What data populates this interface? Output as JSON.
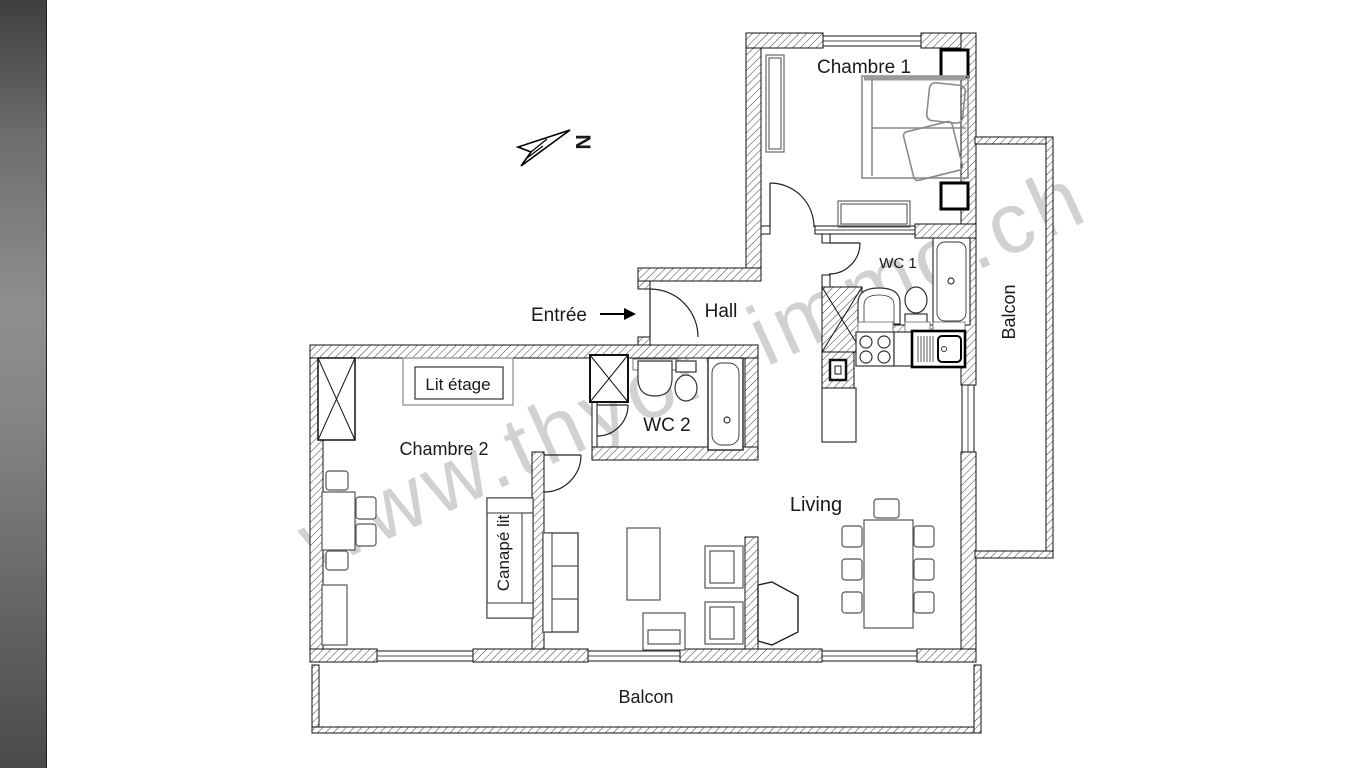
{
  "document": {
    "kind": "apartment-floor-plan"
  },
  "labels": {
    "chambre1": "Chambre 1",
    "balcon_right": "Balcon",
    "hall": "Hall",
    "entree": "Entrée",
    "wc1": "WC 1",
    "wc2": "WC 2",
    "lit_etage": "Lit étage",
    "chambre2": "Chambre 2",
    "canape_lit": "Canapé lit",
    "living": "Living",
    "balcon_bottom": "Balcon"
  },
  "watermark": {
    "text": "www.thyon-immo.ch"
  },
  "compass": {
    "label": "N"
  },
  "colors": {
    "ink": "#1a1a1a",
    "watermark": "#c6c6c6",
    "strip-top": "#3f3f3f",
    "strip-mid": "#8f8f8f",
    "strip-bottom": "#4a4a4a"
  }
}
